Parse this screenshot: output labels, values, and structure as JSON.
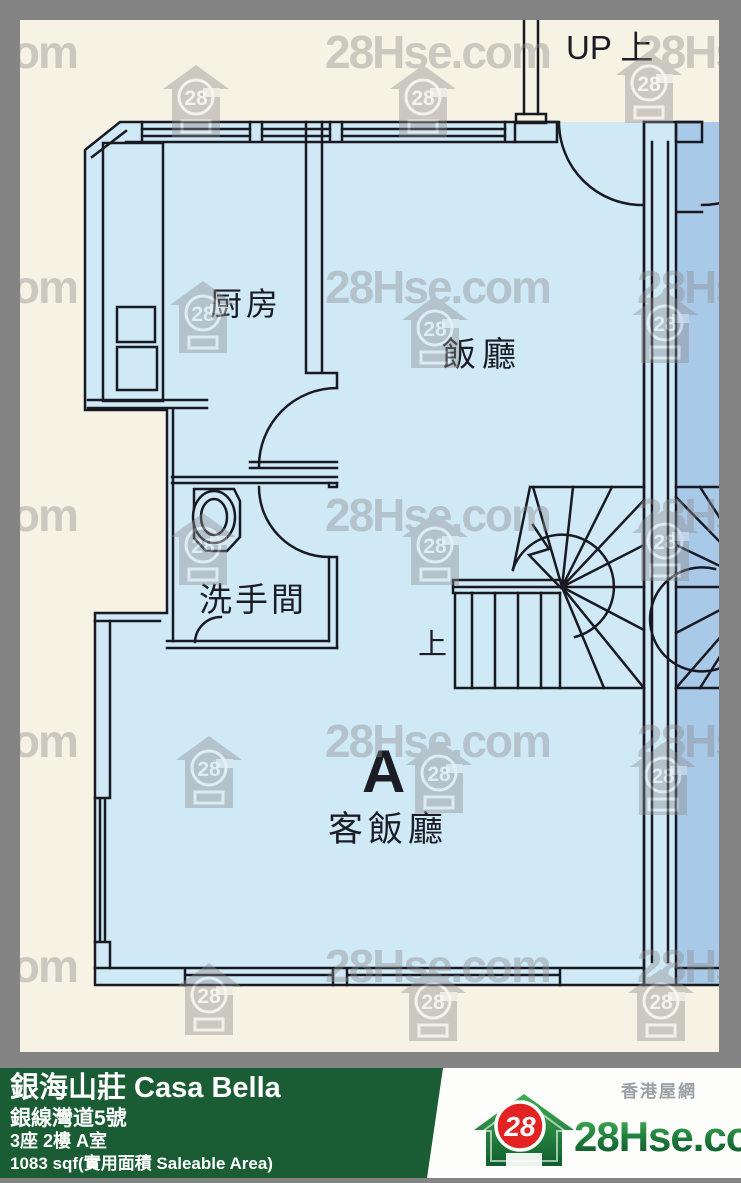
{
  "watermark": {
    "text": "28Hse.com",
    "badge": "28"
  },
  "floorplan": {
    "labels": {
      "up_stair": "UP 上",
      "kitchen": "厨房",
      "dining": "飯廳",
      "toilet": "洗手間",
      "stair_up": "上",
      "unit_letter": "A",
      "living_dining": "客飯廳"
    }
  },
  "info_bar": {
    "estate_name": "銀海山莊 Casa Bella",
    "address": "銀線灣道5號",
    "unit": "3座 2樓 A室",
    "area": "1083 sqf(實用面積 Saleable Area)"
  },
  "logo": {
    "badge": "28",
    "site_name": "28Hse.com",
    "tagline": "香港屋網"
  },
  "colors": {
    "frame_gray": "#848484",
    "paper_cream": "#f6f2e4",
    "unit_fill": "#cfe9f7",
    "adjacent_unit_fill": "#a9c9e9",
    "wall_line": "#191922",
    "bar_green": "#1a5c33",
    "logo_red": "#e32222",
    "logo_green": "#1d7a3b"
  }
}
